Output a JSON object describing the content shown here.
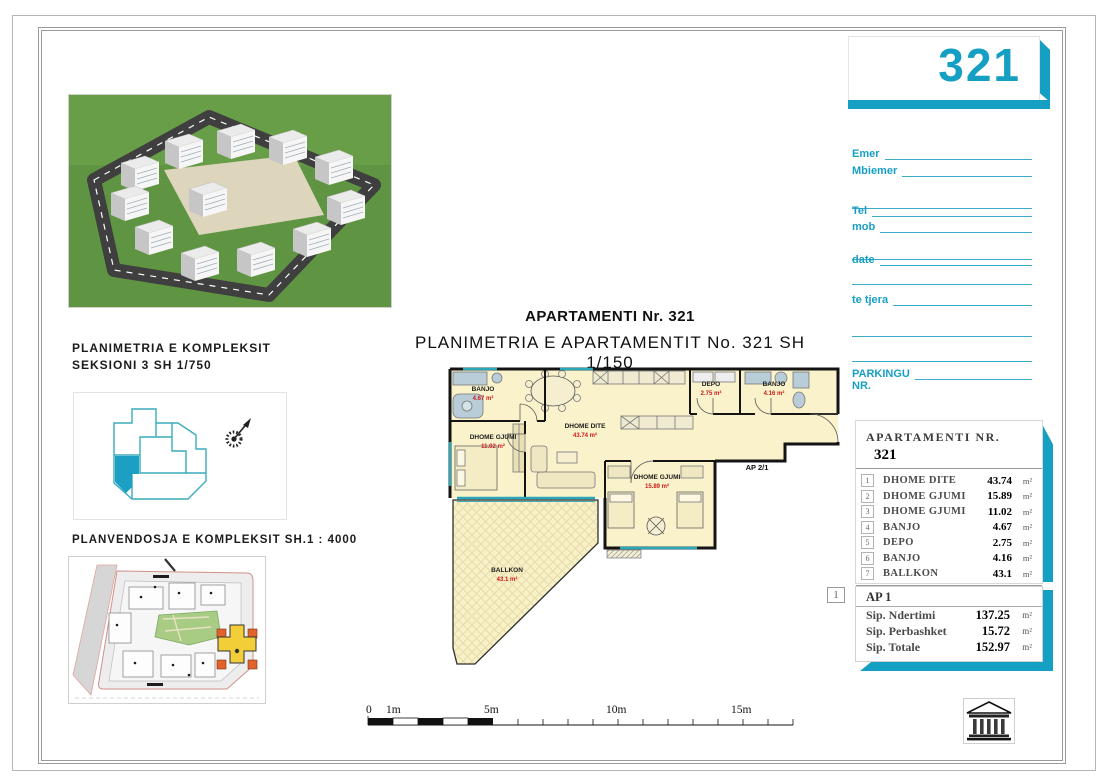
{
  "sheet": {
    "apartment_number": "321"
  },
  "contact_form": {
    "name_label": "Emer",
    "surname_label": "Mbiemer",
    "tel_label": "Tel",
    "mob_label": "mob",
    "date_label": "date",
    "other_label": "te tjera",
    "parking_label": "PARKINGU",
    "parking_nr_label": "NR."
  },
  "left_panel": {
    "complex_plan_title": "PLANIMETRIA E KOMPLEKSIT",
    "complex_plan_scale": "SEKSIONI 3  SH 1/750",
    "site_plan_title": "PLANVENDOSJA E KOMPLEKSIT SH.1 : 4000"
  },
  "main_plan": {
    "title": "APARTAMENTI Nr. 321",
    "subtitle": "PLANIMETRIA E APARTAMENTIT No. 321 SH 1/150",
    "unit_marker": "AP 2/1",
    "rooms": [
      {
        "name": "BANJO",
        "area": "4.67 m²"
      },
      {
        "name": "DHOME GJUMI",
        "area": "11.02 m²"
      },
      {
        "name": "DHOME DITE",
        "area": "43.74 m²"
      },
      {
        "name": "DEPO",
        "area": "2.75 m²"
      },
      {
        "name": "BANJO",
        "area": "4.16 m²"
      },
      {
        "name": "DHOME GJUMI",
        "area": "15.89 m²"
      },
      {
        "name": "BALLKON",
        "area": "43.1 m²"
      }
    ]
  },
  "scale_bar": {
    "labels": [
      "0",
      "1m",
      "5m",
      "10m",
      "15m"
    ]
  },
  "area_table": {
    "title": "APARTAMENTI NR.",
    "number": "321",
    "rows": [
      {
        "no": "1",
        "name": "DHOME DITE",
        "value": "43.74",
        "unit": "m²"
      },
      {
        "no": "2",
        "name": "DHOME GJUMI",
        "value": "15.89",
        "unit": "m²"
      },
      {
        "no": "3",
        "name": "DHOME GJUMI",
        "value": "11.02",
        "unit": "m²"
      },
      {
        "no": "4",
        "name": "BANJO",
        "value": "4.67",
        "unit": "m²"
      },
      {
        "no": "5",
        "name": "DEPO",
        "value": "2.75",
        "unit": "m²"
      },
      {
        "no": "6",
        "name": "BANJO",
        "value": "4.16",
        "unit": "m²"
      },
      {
        "no": "7",
        "name": "BALLKON",
        "value": "43.1",
        "unit": "m²"
      }
    ],
    "total_label": "TOTALE",
    "total_value": "125.33",
    "total_unit": "m²"
  },
  "summary_box": {
    "index": "1",
    "title": "AP 1",
    "rows": [
      {
        "label": "Sip. Ndertimi",
        "value": "137.25",
        "unit": "m²"
      },
      {
        "label": "Sip. Perbashket",
        "value": "15.72",
        "unit": "m²"
      },
      {
        "label": "Sip. Totale",
        "value": "152.97",
        "unit": "m²"
      }
    ]
  },
  "colors": {
    "accent": "#159fc3",
    "plan_area_red": "#cc1919",
    "room_fill": "#faf2cb"
  }
}
